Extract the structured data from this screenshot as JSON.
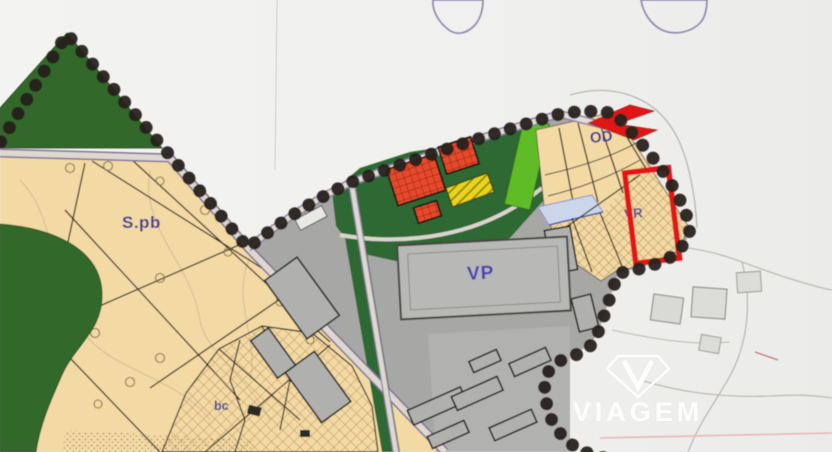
{
  "map": {
    "type": "zoning-plan-scan",
    "zone_labels": {
      "spb": "S.pb",
      "od": "OD",
      "vr": "VR",
      "vp": "VP",
      "bc": "bc"
    },
    "colors": {
      "paper": "#f1f1ef",
      "beige_zone": "#f3d9a4",
      "dark_green_zone": "#33682b",
      "bright_green_zone": "#5ebc25",
      "gray_built_zone": "#a7a7a5",
      "red_building": "#e8492b",
      "yellow_area": "#e8d41e",
      "highlight_red": "#e31515",
      "boundary_dot": "#27211f",
      "label_blue": "#3f3690",
      "road_edge_purple": "#7d6f96"
    }
  },
  "watermark": {
    "brand": "VIAGEM"
  }
}
